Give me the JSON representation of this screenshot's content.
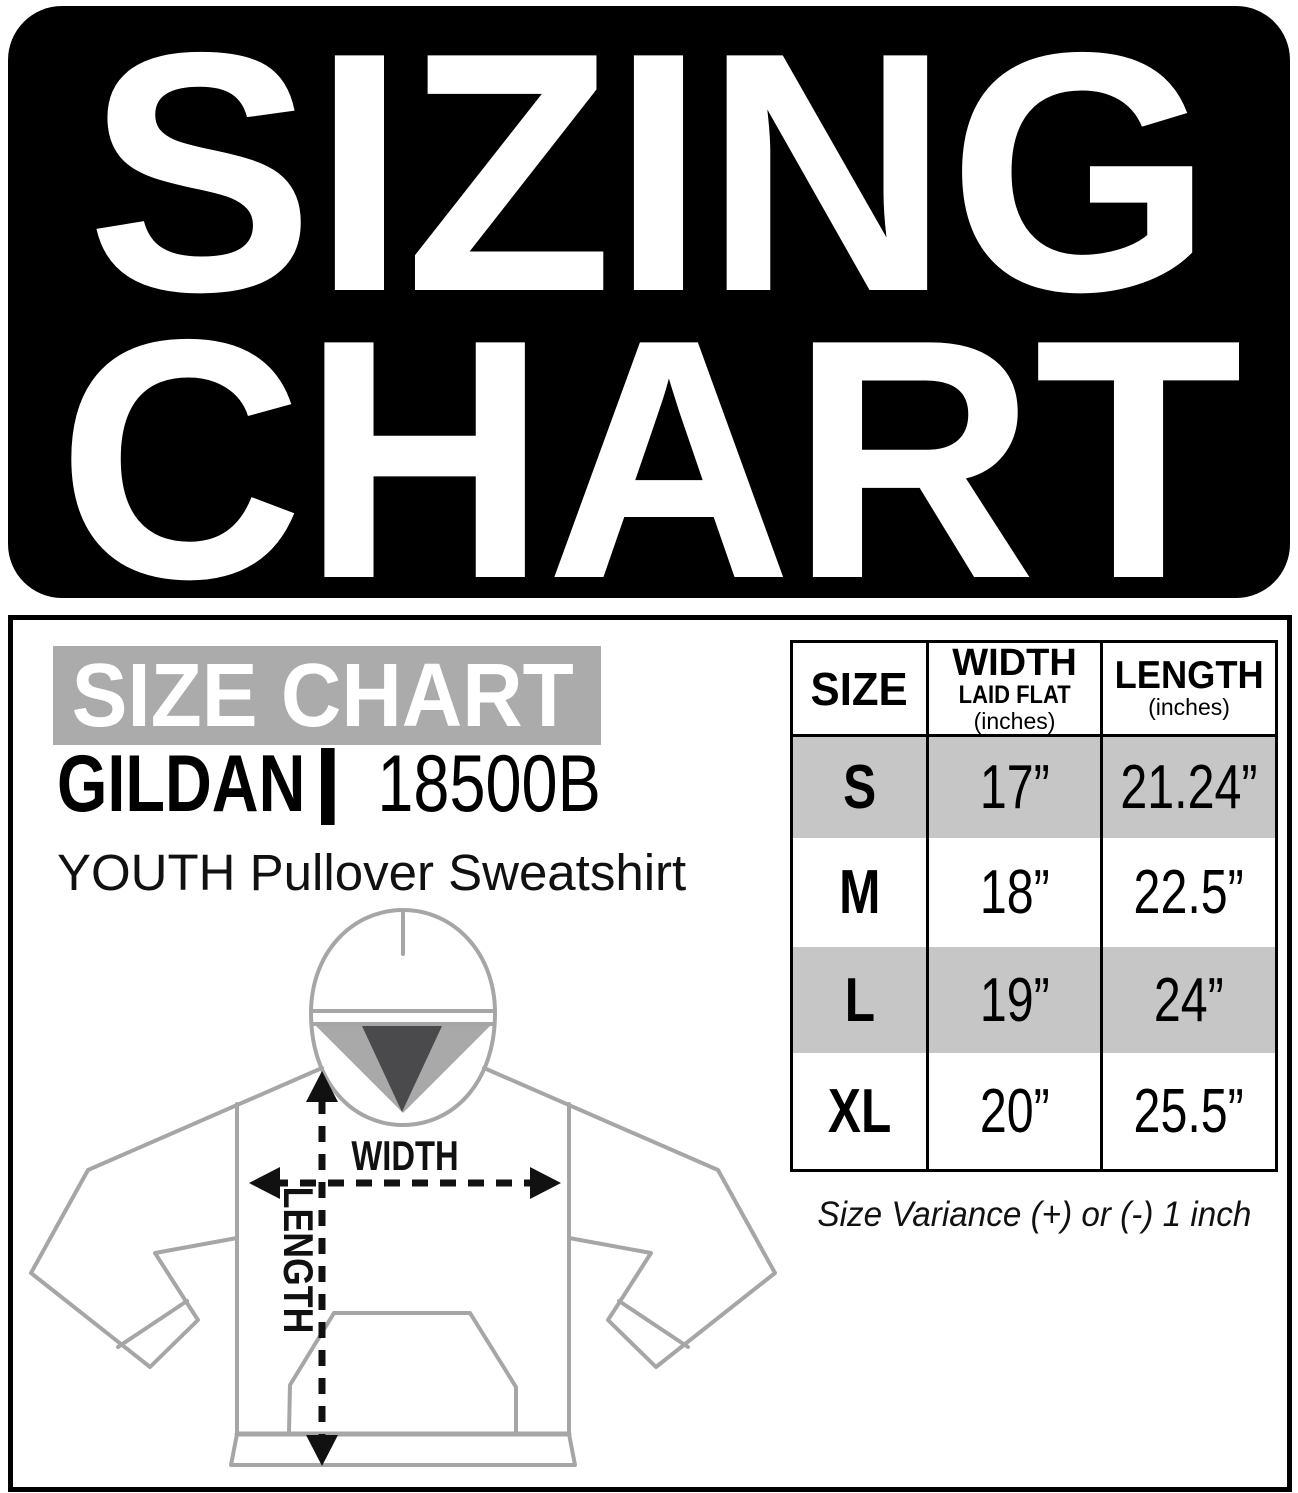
{
  "title": {
    "line1": "SIZING",
    "line2": "CHART"
  },
  "panel": {
    "heading": "SIZE CHART",
    "brand": "GILDAN",
    "model": "18500B",
    "product": "YOUTH Pullover Sweatshirt"
  },
  "diagram": {
    "width_label": "WIDTH",
    "length_label": "LENGTH"
  },
  "chart_data": {
    "type": "table",
    "title": "SIZE CHART",
    "product": "GILDAN 18500B YOUTH Pullover Sweatshirt",
    "columns": [
      {
        "label": "SIZE",
        "sublabel": "",
        "unit": ""
      },
      {
        "label": "WIDTH",
        "sublabel": "LAID FLAT",
        "unit": "(inches)"
      },
      {
        "label": "LENGTH",
        "sublabel": "",
        "unit": "(inches)"
      }
    ],
    "rows": [
      {
        "size": "S",
        "width": "17”",
        "length": "21.24”"
      },
      {
        "size": "M",
        "width": "18”",
        "length": "22.5”"
      },
      {
        "size": "L",
        "width": "19”",
        "length": "24”"
      },
      {
        "size": "XL",
        "width": "20”",
        "length": "25.5”"
      }
    ],
    "note": "Size Variance (+) or (-) 1 inch"
  },
  "colors": {
    "plate_black": "#000000",
    "heading_bar_gray": "#ababab",
    "row_shade_gray": "#c6c6c6",
    "hood_inner_gray": "#a9a9a9",
    "hood_inner_dark": "#4a4a4c",
    "outline_gray": "#a6a6a6",
    "arrow_black": "#111111"
  }
}
